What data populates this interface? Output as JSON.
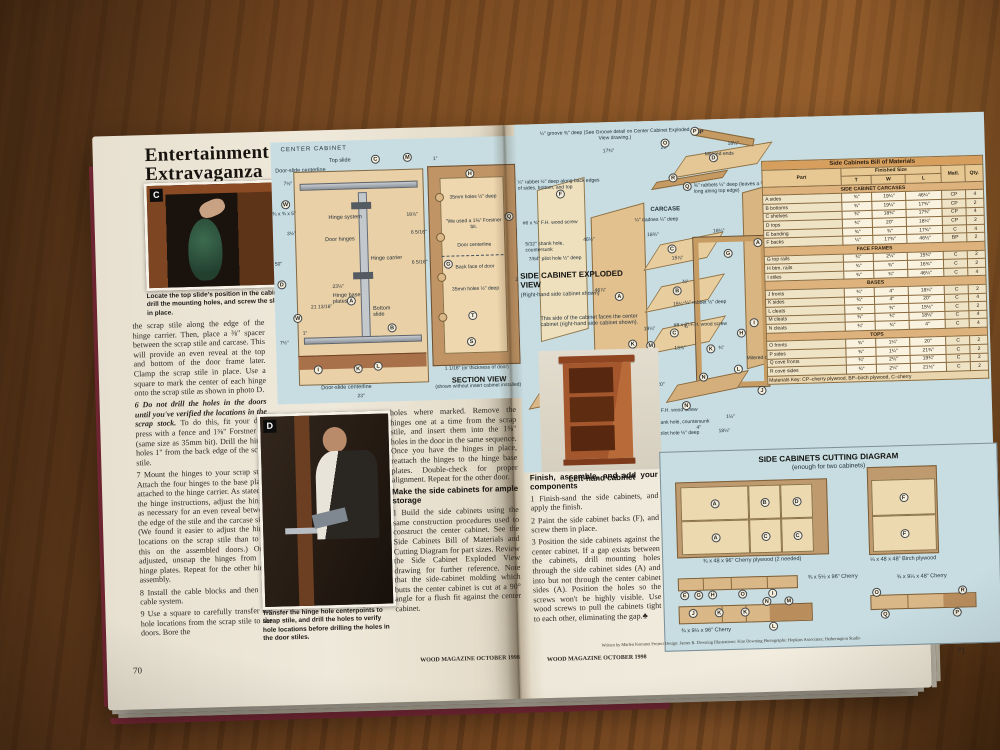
{
  "letters": {
    "A": "A",
    "B": "B",
    "C": "C",
    "D": "D",
    "E": "E",
    "F": "F",
    "G": "G",
    "H": "H",
    "I": "I",
    "J": "J",
    "K": "K",
    "L": "L",
    "M": "M",
    "N": "N",
    "O": "O",
    "P": "P",
    "Q": "Q",
    "R": "R",
    "S": "S",
    "T": "T",
    "W": "W"
  },
  "article": {
    "title_line1": "Entertainment",
    "title_line2": "Extravaganza"
  },
  "photo_c": {
    "label": "C",
    "caption": "Locate the top slide's position in the cabinet, drill the mounting holes, and screw the slide in place."
  },
  "photo_d": {
    "label": "D",
    "caption": "Transfer the hinge hole centerpoints to scrap stile, and drill the holes to verify hole locations before drilling the holes in the door stiles."
  },
  "col1": {
    "p1": "the scrap stile along the edge of the hinge carrier. Then, place a ⅜\" spacer between the scrap stile and carcase. This will provide an even reveal at the top and bottom of the door frame later. Clamp the scrap stile in place. Use a square to mark the center of each hinge onto the scrap stile as shown in photo D.",
    "p2a": "6 Do not drill the holes in the doors until you've verified the locations in the scrap stock.",
    "p2b": " To do this, fit your drill press with a fence and 1⅜\" Forstner bit (same size as 35mm bit). Drill the hinge holes 1\" from the back edge of the scrap stile.",
    "p3": "7 Mount the hinges to your scrap stile. Attach the four hinges to the base plates attached to the hinge carrier. As stated in the hinge instructions, adjust the hinges as necessary for an even reveal between the edge of the stile and the carcase side. (We found it easier to adjust the hinge locations on the scrap stile than to do this on the assembled doors.) Once adjusted, unsnap the hinges from the hinge plates. Repeat for the other hinge assembly.",
    "p4": "8 Install the cable blocks and then the cable system.",
    "p5": "9 Use a square to carefully transfer the hole locations from the scrap stile to the doors. Bore the"
  },
  "col2": {
    "p1": "holes where marked. Remove the hinges one at a time from the scrap stile, and insert them into the 1⅜\" holes in the door in the same sequence. Once you have the hinges in place, reattach the hinges to the hinge base plates. Double-check for proper alignment. Repeat for the other door.",
    "h1": "Make the side cabinets for ample storage",
    "p2": "1 Build the side cabinets using the same construction procedures used to construct the center cabinet. See the Side Cabinets Bill of Materials and Cutting Diagram for part sizes. Review the Side Cabinet Exploded View drawing for further reference. Note that the side-cabinet molding which butts the center cabinet is cut at a 90° angle for a flush fit against the center cabinet."
  },
  "col3": {
    "h1": "Finish, assemble, and add your components",
    "p1": "1 Finish-sand the side cabinets, and apply the finish.",
    "p2": "2 Paint the side cabinet backs (F), and screw them in place.",
    "p3": "3 Position the side cabinets against the center cabinet. If a gap exists between the cabinets, drill mounting holes through the side cabinet sides (A) and into but not through the center cabinet sides (A). Position the holes so the screws won't be highly visible. Use wood screws to pull the cabinets tight to each other, eliminating the gap.♣"
  },
  "center_diagram": {
    "title": "CENTER CABINET",
    "lbl_top_slide": "Top slide",
    "lbl_cl_top": "Door-slide centerline",
    "lbl_cl_bottom": "Door-slide centerline",
    "lbl_hinge_system": "Hinge system",
    "lbl_door_hinges": "Door hinges",
    "lbl_hinge_carrier": "Hinge carrier",
    "lbl_base_plates": "Hinge base plates",
    "lbl_bottom_slide": "Bottom slide",
    "dim_7_5_top": "7½\"",
    "dim_w_part": "¾ x ¾ x 5\"",
    "dim_3_5": "3½\"",
    "dim_50": "50\"",
    "dim_23_1_8": "23⅛\"",
    "dim_21_13_16": "21 13/16\"",
    "dim_1": "1\"",
    "dim_7_5_bot": "7½\"",
    "dim_23": "23\"",
    "dim_18_7_8": "18⅞\""
  },
  "section_view": {
    "dim_1": "1\"",
    "lbl_35mm_top": "35mm holes ½\" deep",
    "lbl_forstner": "\"We used a 1⅜\" Forstner bit.",
    "lbl_door_cl": "Door centerline",
    "lbl_back_face": "Back face of door",
    "lbl_35mm_bot": "35mm holes ½\" deep",
    "dim_6_5_16_a": "6 5/16\"",
    "dim_6_5_16_b": "6 5/16\"",
    "dim_48": "48\"",
    "dim_23": "23\"",
    "thickness": "1 1/16\" (or thickness of door)",
    "title": "SECTION VIEW",
    "subtitle": "(shown without insert cabinet installed)"
  },
  "exploded": {
    "note_groove": "¼\" groove ⅜\" deep (See Groove detail on Center Cabinet Exploded View drawing.)",
    "note_rabbet_back": "¼\" rabbet ½\" deep along back edges of sides, bottom, and top",
    "note_rabbets_top": "⅜\" rabbets ¼\" deep (leaves a ¼\" tenon ⅜\" long along top edge)",
    "note_dadoes": "¼\" dadoes ¼\" deep",
    "note_screw_6": "#6 x ¾\" F.H. wood screw",
    "note_shank": "5/32\" shank hole, countersunk",
    "note_pilot": "7/64\" pilot hole ½\" deep",
    "note_rabbet_small": "¼\" rabbet ½\" deep",
    "note_screw_8_2": "#8 x 2\" F.H. wood screw",
    "note_screw_8_125": "#8 x 1¼\" F.H. wood screw",
    "note_shank2": "5/32\" shank hole, countersunk",
    "note_pilot2": "7/64\" pilot hole ½\" deep",
    "lbl_top": "TOP",
    "lbl_carcase": "CARCASE",
    "lbl_base": "BASE",
    "lbl_mitered_ends": "Mitered ends",
    "lbl_mitered_corner": "Mitered corner",
    "title": "SIDE CABINET EXPLODED VIEW",
    "subtitle": "(Right-hand side cabinet shown)",
    "note_side": "This side of the cabinet faces the center cabinet (right-hand side cabinet shown).",
    "dim_20_top": "20\"",
    "dim_18_25_top": "18¼\"",
    "dim_17_75": "17¾\"",
    "dim_46_5": "46½\"",
    "dim_46_875": "46⅞\"",
    "dim_18_75": "18¾\"",
    "dim_15_875": "15⅞\"",
    "dim_15_25": "15¼\"",
    "dim_13_875": "13⅞\"",
    "dim_18_25_frame": "18¼\"",
    "dim_46_25": "46¼\"",
    "dim_75_a": "¾\"",
    "dim_75_b": "¾\"",
    "dim_75_c": "¾\"",
    "dim_19_25": "19¼\"",
    "dim_4_a": "4\"",
    "dim_20_base": "20\"",
    "dim_1_5": "1½\"",
    "dim_4_b": "4\"",
    "dim_18_25_base": "18¼\"",
    "photo_caption": "Left-hand cabinet"
  },
  "bom": {
    "title": "Side Cabinets Bill of Materials",
    "h_part": "Part",
    "h_size": "Finished Size",
    "h_t": "T",
    "h_w": "W",
    "h_l": "L",
    "h_m": "Matl.",
    "h_q": "Qty.",
    "sec1": "SIDE CABINET CARCASES",
    "carcases": [
      {
        "part": "A  sides",
        "t": "¾\"",
        "w": "19¼\"",
        "l": "46¼\"",
        "m": "CP",
        "q": "4"
      },
      {
        "part": "B  bottoms",
        "t": "¾\"",
        "w": "19¼\"",
        "l": "17¾\"",
        "m": "CP",
        "q": "2"
      },
      {
        "part": "C  shelves",
        "t": "¾\"",
        "w": "18¾\"",
        "l": "17¾\"",
        "m": "CP",
        "q": "4"
      },
      {
        "part": "D  tops",
        "t": "¾\"",
        "w": "20\"",
        "l": "18¼\"",
        "m": "CP",
        "q": "2"
      },
      {
        "part": "E  banding",
        "t": "¾\"",
        "w": "¾\"",
        "l": "17¾\"",
        "m": "C",
        "q": "4"
      },
      {
        "part": "F  backs",
        "t": "¼\"",
        "w": "17¾\"",
        "l": "46½\"",
        "m": "BP",
        "q": "2"
      }
    ],
    "sec2": "FACE FRAMES",
    "frames": [
      {
        "part": "G  top rails",
        "t": "¾\"",
        "w": "2¼\"",
        "l": "15¾\"",
        "m": "C",
        "q": "2"
      },
      {
        "part": "H  btm. rails",
        "t": "¾\"",
        "w": "¾\"",
        "l": "16¾\"",
        "m": "C",
        "q": "2"
      },
      {
        "part": "I  stiles",
        "t": "¾\"",
        "w": "¾\"",
        "l": "46¼\"",
        "m": "C",
        "q": "4"
      }
    ],
    "sec3": "BASES",
    "bases": [
      {
        "part": "J  fronts",
        "t": "¾\"",
        "w": "4\"",
        "l": "18¼\"",
        "m": "C",
        "q": "2"
      },
      {
        "part": "K  sides",
        "t": "¾\"",
        "w": "4\"",
        "l": "20\"",
        "m": "C",
        "q": "4"
      },
      {
        "part": "L  cleats",
        "t": "¾\"",
        "w": "¾\"",
        "l": "15½\"",
        "m": "C",
        "q": "2"
      },
      {
        "part": "M  cleats",
        "t": "¾\"",
        "w": "¾\"",
        "l": "18⅛\"",
        "m": "C",
        "q": "4"
      },
      {
        "part": "N  cleats",
        "t": "¾\"",
        "w": "¾\"",
        "l": "4\"",
        "m": "C",
        "q": "4"
      }
    ],
    "sec4": "TOPS",
    "tops": [
      {
        "part": "O  fronts",
        "t": "¾\"",
        "w": "1¼\"",
        "l": "20\"",
        "m": "C",
        "q": "2"
      },
      {
        "part": "P  sides",
        "t": "¾\"",
        "w": "1¼\"",
        "l": "21¾\"",
        "m": "C",
        "q": "2"
      },
      {
        "part": "Q  cove fronts",
        "t": "¾\"",
        "w": "2⅛\"",
        "l": "19¾\"",
        "m": "C",
        "q": "2"
      },
      {
        "part": "R  cove sides",
        "t": "¾\"",
        "w": "2¼\"",
        "l": "21½\"",
        "m": "C",
        "q": "2"
      }
    ],
    "key": "Materials Key: CP–cherry plywood, BP–birch plywood, C–cherry"
  },
  "cutting": {
    "title": "SIDE CABINETS CUTTING DIAGRAM",
    "subtitle": "(enough for two cabinets)",
    "caption_sheet1": "¾ x 48 x 96\" Cherry plywood (2 needed)",
    "caption_birch": "¼ x 48 x 48\" Birch plywood",
    "caption_board2": "¾ x 5½ x 96\" Cherry",
    "caption_board3": "¾ x 9¼ x 96\" Cherry",
    "caption_board4": "¾ x 9¼ x 48\" Cherry"
  },
  "footer": {
    "wood_left": "WOOD MAGAZINE   OCTOBER 1998",
    "wood_right": "WOOD MAGAZINE   OCTOBER 1998",
    "page_left": "70",
    "page_right": "71",
    "credits": "Written by Marlen Kemmet     Project Design: James R. Downing     Illustrations: Kim Downing     Photographs: Hopkins Associates; Hetherington Studio"
  }
}
